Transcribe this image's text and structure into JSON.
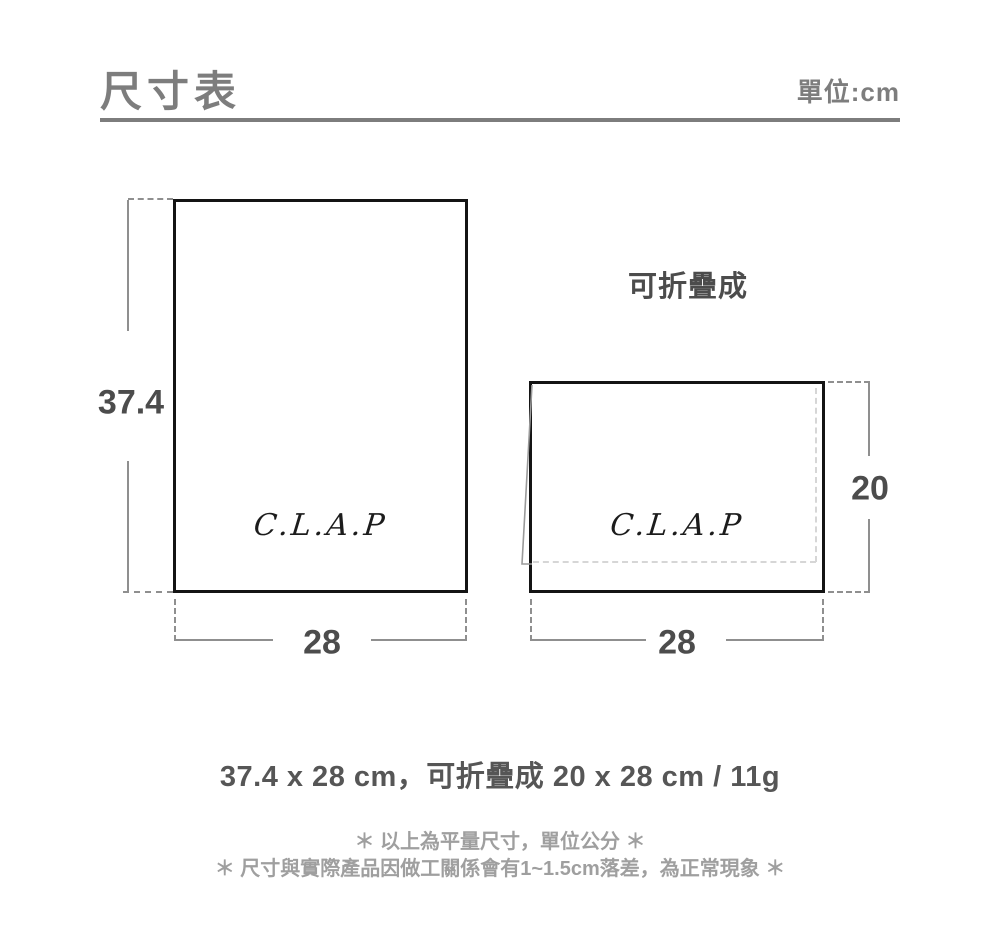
{
  "header": {
    "title": "尺寸表",
    "unit_label": "單位:cm"
  },
  "diagram": {
    "unfolded": {
      "brand": "C.L.A.P",
      "height_cm": "37.4",
      "width_cm": "28"
    },
    "folded": {
      "caption": "可折疊成",
      "brand": "C.L.A.P",
      "height_cm": "20",
      "width_cm": "28"
    }
  },
  "summary": "37.4 x 28 cm，可折疊成 20 x 28 cm / 11g",
  "notes": [
    "＊ 以上為平量尺寸，單位公分 ＊",
    "＊ 尺寸與實際產品因做工關係會有1~1.5cm落差，為正常現象 ＊"
  ],
  "colors": {
    "title_gray": "#7d7d7d",
    "label_dark": "#4c4c4c",
    "dimension_line_gray": "#8f8f8f",
    "fold_dash_gray": "#d6d6d6",
    "note_gray": "#9f9f9f",
    "rect_border_black": "#141414",
    "summary_gray": "#565656"
  }
}
